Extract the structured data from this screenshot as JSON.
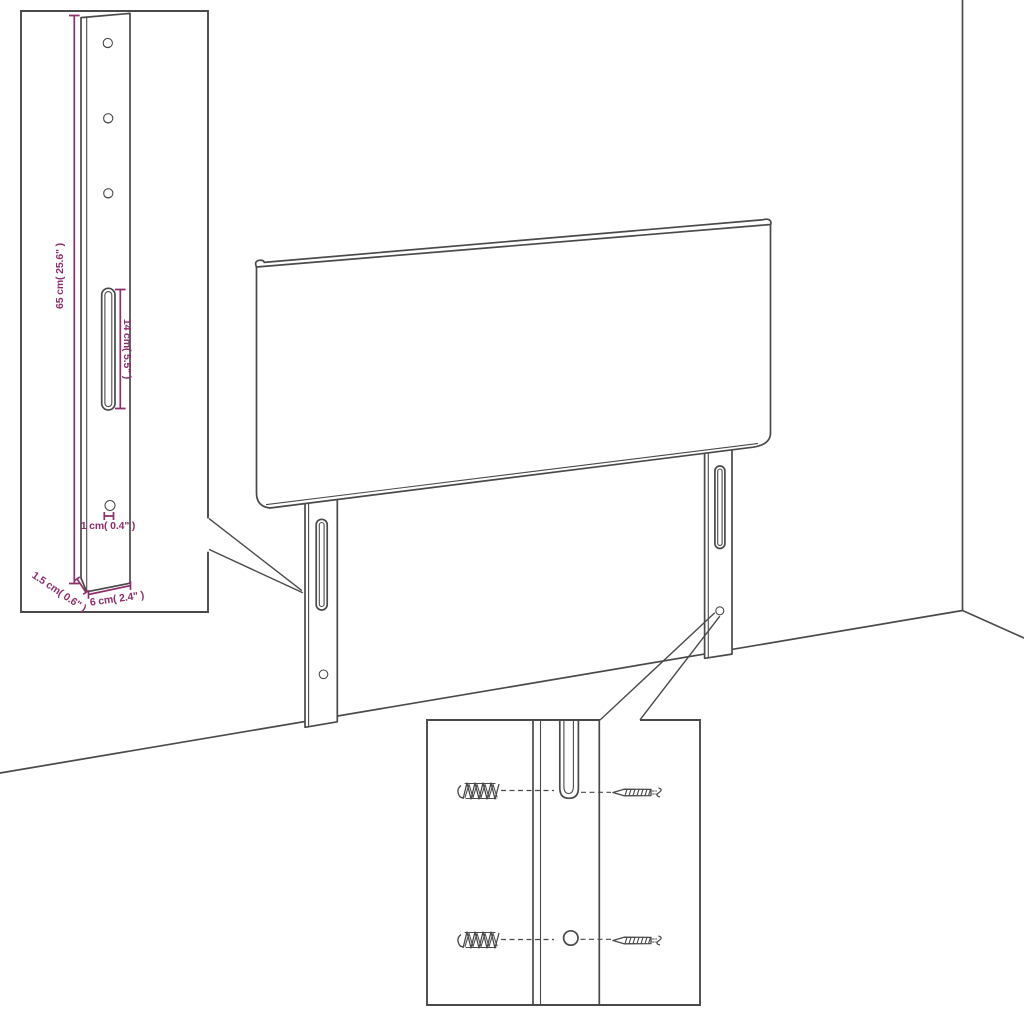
{
  "colors": {
    "background": "#ffffff",
    "line": "#4a4a4a",
    "dimension": "#8d2f6b"
  },
  "bracket_detail": {
    "dims": {
      "height": "65 cm( 25.6\" )",
      "slot_length": "14 cm( 5.5\" )",
      "hole_diameter": "1 cm( 0.4\" )",
      "thickness": "1.5 cm( 0.6\" )",
      "width": "6 cm( 2.4\" )"
    }
  },
  "hardware_detail": {
    "icons": [
      "wall-plug-icon",
      "screw-icon"
    ]
  }
}
